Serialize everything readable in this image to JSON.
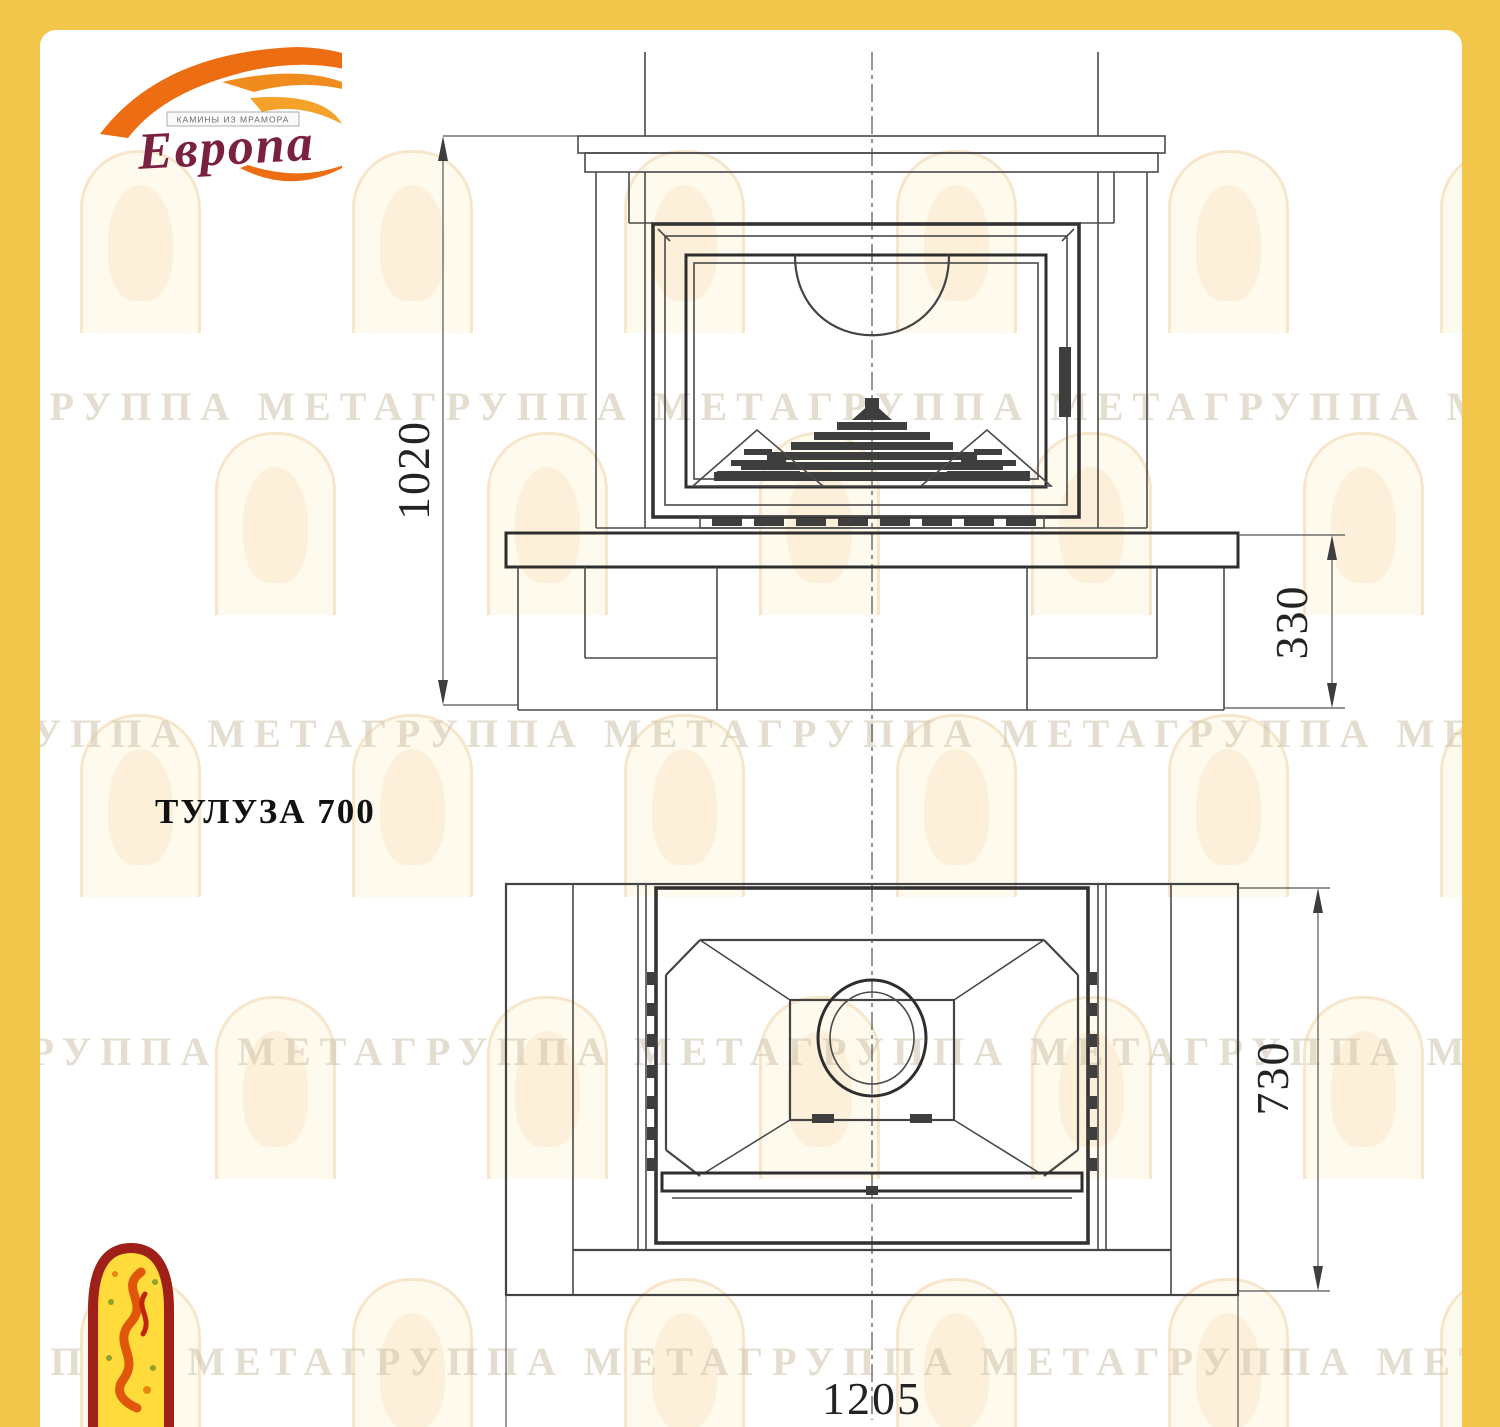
{
  "title": "ТУЛУЗА 700",
  "logo": {
    "brand": "Европа",
    "tagline": "КАМИНЫ ИЗ МРАМОРА"
  },
  "watermark": {
    "text": "ГРУППА МЕТАГРУППА МЕТАГРУППА МЕТАГРУППА МЕТА"
  },
  "drawing": {
    "model": "ТУЛУЗА 700",
    "views": {
      "front": {
        "label": "front-view",
        "dims": {
          "overall_height": "1020",
          "plinth_height": "330"
        }
      },
      "plan": {
        "label": "plan-view",
        "dims": {
          "depth": "730",
          "overall_width": "1205"
        }
      }
    }
  },
  "colors": {
    "frame": "#F2C64B",
    "paper": "#FFFFFF",
    "line": "#4a4a4a",
    "accent_orange": "#EC6D12",
    "brand_red": "#7A2040",
    "emblem_yellow": "#FFDC3C",
    "emblem_border": "#9E2018"
  }
}
